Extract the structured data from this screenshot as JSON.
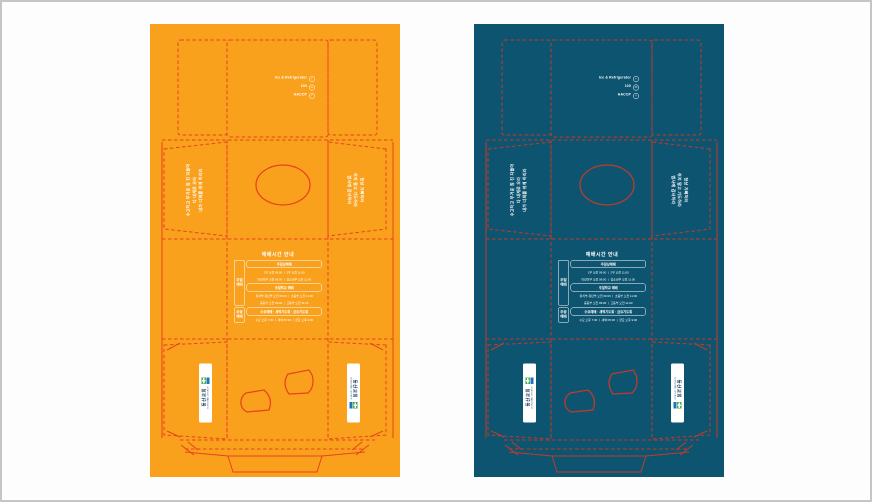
{
  "page": {
    "background": "#fdfdfd",
    "frame_border_color": "#c5c5c5",
    "description": "Two box packaging dieline proofs side by side, identical artwork in two colorways"
  },
  "variants": [
    {
      "name": "orange",
      "panel_color": "#F9A11C",
      "line_color": "#E8431C"
    },
    {
      "name": "teal",
      "panel_color": "#0D5470",
      "line_color": "#C23A28"
    }
  ],
  "content": {
    "top_notes": [
      {
        "label": "Ice & Refrigerator",
        "icon": "+"
      },
      {
        "label": "100",
        "icon": "%"
      },
      {
        "label": "HACCP",
        "icon": "✓"
      }
    ],
    "left_side_text": {
      "line1": "수고하고 무거운 짐 진 자들아",
      "line2": "다 내게로 오라",
      "line3": "내가 너희를 쉬게 하리라"
    },
    "right_side_text": {
      "line1": "항상 기뻐하라",
      "line2": "쉬지 말고 기도하라",
      "line3": "범사에 감사하라"
    },
    "table": {
      "title": "예배시간 안내",
      "label1": "주일예배",
      "pill1": "주일낮예배",
      "r1l1": "1부 오전 09:00 ㅣ 2부 오전 11:00",
      "r1l2": "어린이부 오전 09:00 ㅣ 청소년부 오전 11:00",
      "pill2": "주일학교 예배",
      "r2l1": "유치부·유년부 오전 09:00 ㅣ 초등부 오전 11:00",
      "r2l2": "중등부 오전 09:00 ㅣ 고등부 오전 11:00",
      "label2": "주중예배",
      "pill3": "수요예배 · 새벽기도회 · 금요기도회",
      "r3l1": "수요 오후 7:30 ㅣ 새벽 05:00 ㅣ 금요 오후 9:00"
    },
    "logo": {
      "main": "동산교회",
      "sub": "DONGSAN CHURCH",
      "green": "#3FAE49",
      "blue": "#1B75BC"
    }
  }
}
